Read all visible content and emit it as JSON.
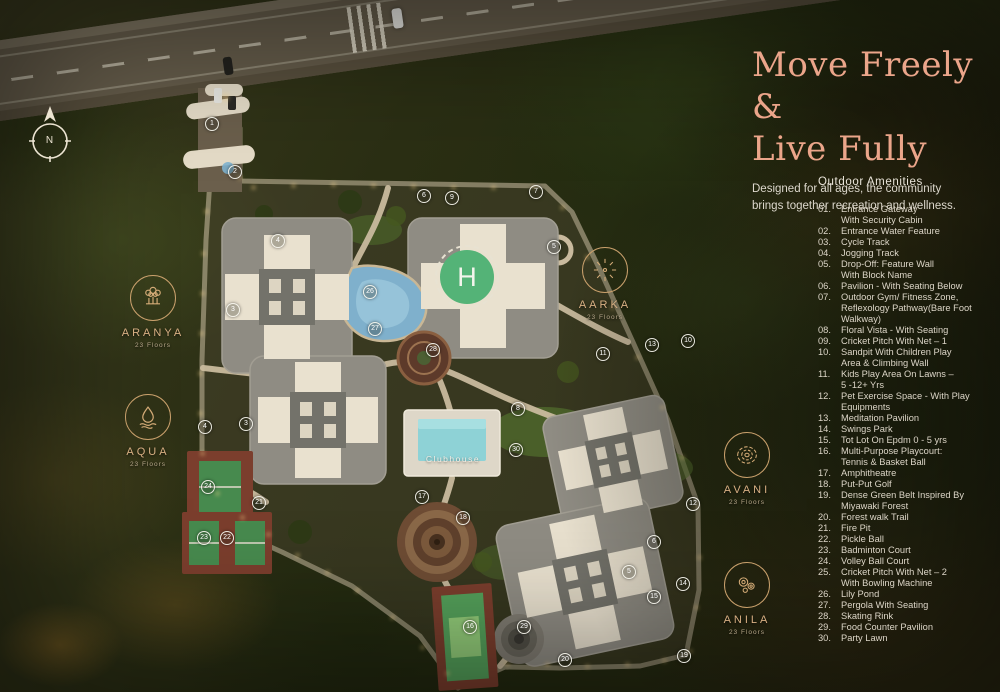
{
  "page": {
    "title_line1": "Move Freely &",
    "title_line2": "Live Fully",
    "subtitle_line1": "Designed for all ages, the community",
    "subtitle_line2": "brings together recreation and wellness."
  },
  "amenities": {
    "heading": "Outdoor Amenities",
    "items": [
      {
        "num": "01.",
        "lines": [
          "Entrance Gateway",
          "With Security Cabin"
        ]
      },
      {
        "num": "02.",
        "lines": [
          "Entrance Water Feature"
        ]
      },
      {
        "num": "03.",
        "lines": [
          "Cycle Track"
        ]
      },
      {
        "num": "04.",
        "lines": [
          "Jogging Track"
        ]
      },
      {
        "num": "05.",
        "lines": [
          "Drop-Off: Feature Wall",
          "With Block Name"
        ]
      },
      {
        "num": "06.",
        "lines": [
          "Pavilion - With Seating Below"
        ]
      },
      {
        "num": "07.",
        "lines": [
          "Outdoor Gym/ Fitness Zone,",
          "Reflexology Pathway(Bare Foot",
          "Walkway)"
        ]
      },
      {
        "num": "08.",
        "lines": [
          "Floral Vista - With Seating"
        ]
      },
      {
        "num": "09.",
        "lines": [
          "Cricket Pitch With Net – 1"
        ]
      },
      {
        "num": "10.",
        "lines": [
          "Sandpit With Children Play",
          "Area & Climbing Wall"
        ]
      },
      {
        "num": "11.",
        "lines": [
          "Kids Play Area On Lawns –",
          "5 -12+ Yrs"
        ]
      },
      {
        "num": "12.",
        "lines": [
          "Pet Exercise Space - With Play",
          "Equipments"
        ]
      },
      {
        "num": "13.",
        "lines": [
          "Meditation Pavilion"
        ]
      },
      {
        "num": "14.",
        "lines": [
          "Swings Park"
        ]
      },
      {
        "num": "15.",
        "lines": [
          "Tot Lot On Epdm 0 - 5 yrs"
        ]
      },
      {
        "num": "16.",
        "lines": [
          "Multi-Purpose Playcourt:",
          "Tennis & Basket Ball"
        ]
      },
      {
        "num": "17.",
        "lines": [
          "Amphitheatre"
        ]
      },
      {
        "num": "18.",
        "lines": [
          "Put-Put Golf"
        ]
      },
      {
        "num": "19.",
        "lines": [
          "Dense Green Belt Inspired By",
          "Miyawaki Forest"
        ]
      },
      {
        "num": "20.",
        "lines": [
          "Forest walk Trail"
        ]
      },
      {
        "num": "21.",
        "lines": [
          "Fire Pit"
        ]
      },
      {
        "num": "22.",
        "lines": [
          "Pickle Ball"
        ]
      },
      {
        "num": "23.",
        "lines": [
          "Badminton Court"
        ]
      },
      {
        "num": "24.",
        "lines": [
          "Volley Ball Court"
        ]
      },
      {
        "num": "25.",
        "lines": [
          "Cricket Pitch With Net – 2",
          "With Bowling Machine"
        ]
      },
      {
        "num": "26.",
        "lines": [
          "Lily Pond"
        ]
      },
      {
        "num": "27.",
        "lines": [
          "Pergola With Seating"
        ]
      },
      {
        "num": "28.",
        "lines": [
          "Skating Rink"
        ]
      },
      {
        "num": "29.",
        "lines": [
          "Food Counter Pavilion"
        ]
      },
      {
        "num": "30.",
        "lines": [
          "Party Lawn"
        ]
      }
    ]
  },
  "map": {
    "compass_label": "N",
    "helipad_label": "H",
    "clubhouse_label": "Clubhouse",
    "towers": [
      {
        "name": "ARANYA",
        "floors": "23 Floors",
        "icon": "banyan-tree",
        "x": 153,
        "y": 298
      },
      {
        "name": "AQUA",
        "floors": "23 Floors",
        "icon": "water-drop",
        "x": 148,
        "y": 417
      },
      {
        "name": "AARKA",
        "floors": "23 Floors",
        "icon": "sunburst",
        "x": 605,
        "y": 270
      },
      {
        "name": "AVANI",
        "floors": "23 Floors",
        "icon": "terrain-contours",
        "x": 747,
        "y": 455
      },
      {
        "name": "ANILA",
        "floors": "23 Floors",
        "icon": "wind-swirls",
        "x": 747,
        "y": 585
      }
    ],
    "markers": [
      {
        "n": "1",
        "x": 212,
        "y": 124
      },
      {
        "n": "2",
        "x": 235,
        "y": 172
      },
      {
        "n": "4",
        "x": 278,
        "y": 241
      },
      {
        "n": "3",
        "x": 233,
        "y": 310
      },
      {
        "n": "6",
        "x": 424,
        "y": 196
      },
      {
        "n": "9",
        "x": 452,
        "y": 198
      },
      {
        "n": "7",
        "x": 536,
        "y": 192
      },
      {
        "n": "5",
        "x": 554,
        "y": 247
      },
      {
        "n": "26",
        "x": 370,
        "y": 292
      },
      {
        "n": "27",
        "x": 375,
        "y": 329
      },
      {
        "n": "28",
        "x": 433,
        "y": 350
      },
      {
        "n": "13",
        "x": 652,
        "y": 345
      },
      {
        "n": "11",
        "x": 603,
        "y": 354
      },
      {
        "n": "10",
        "x": 688,
        "y": 341
      },
      {
        "n": "8",
        "x": 518,
        "y": 409
      },
      {
        "n": "30",
        "x": 516,
        "y": 450
      },
      {
        "n": "4",
        "x": 205,
        "y": 427
      },
      {
        "n": "3",
        "x": 246,
        "y": 424
      },
      {
        "n": "24",
        "x": 208,
        "y": 487
      },
      {
        "n": "21",
        "x": 259,
        "y": 503
      },
      {
        "n": "23",
        "x": 204,
        "y": 538
      },
      {
        "n": "22",
        "x": 227,
        "y": 538
      },
      {
        "n": "17",
        "x": 422,
        "y": 497
      },
      {
        "n": "18",
        "x": 463,
        "y": 518
      },
      {
        "n": "29",
        "x": 524,
        "y": 627
      },
      {
        "n": "20",
        "x": 565,
        "y": 660
      },
      {
        "n": "19",
        "x": 684,
        "y": 656
      },
      {
        "n": "16",
        "x": 470,
        "y": 627
      },
      {
        "n": "12",
        "x": 693,
        "y": 504
      },
      {
        "n": "6",
        "x": 654,
        "y": 542
      },
      {
        "n": "5",
        "x": 629,
        "y": 572
      },
      {
        "n": "15",
        "x": 654,
        "y": 597
      },
      {
        "n": "14",
        "x": 683,
        "y": 584
      }
    ]
  },
  "colors": {
    "title_accent": "#e9a58a",
    "label_gold": "#d4ab77",
    "path_cream": "#c9ba9e",
    "helipad_green": "#54b377",
    "pool_teal": "#8ed2d6",
    "court_green": "#478a4e",
    "court_clay": "#7b3e2d"
  }
}
